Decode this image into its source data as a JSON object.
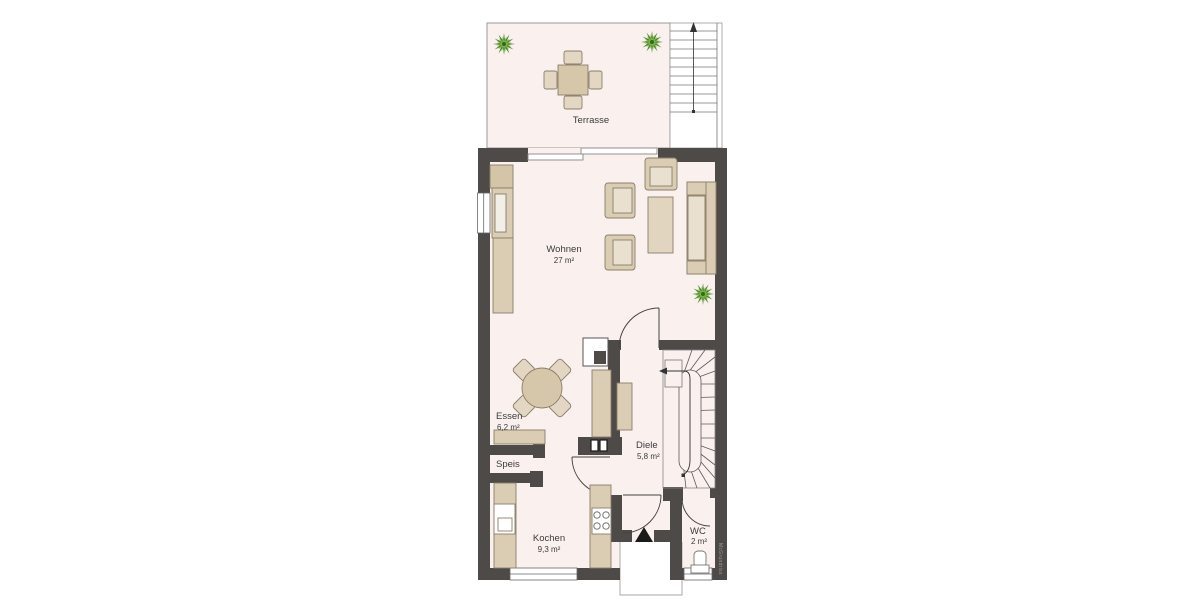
{
  "plan": {
    "watermark": "McGrundriss",
    "rooms": {
      "terrasse": {
        "name": "Terrasse",
        "area": ""
      },
      "wohnen": {
        "name": "Wohnen",
        "area": "27 m²"
      },
      "essen": {
        "name": "Essen",
        "area": "6,2 m²"
      },
      "speis": {
        "name": "Speis",
        "area": ""
      },
      "kochen": {
        "name": "Kochen",
        "area": "9,3 m²"
      },
      "diele": {
        "name": "Diele",
        "area": "5,8 m²"
      },
      "wc": {
        "name": "WC",
        "area": "2 m²"
      }
    },
    "colors": {
      "floor": "#faf1ef",
      "wall": "#4d4a47",
      "furniture": "#dbcdb4",
      "furniture_light": "#eae0cf",
      "plant_green": "#5e9c33",
      "outline": "#8a7e6a"
    }
  }
}
